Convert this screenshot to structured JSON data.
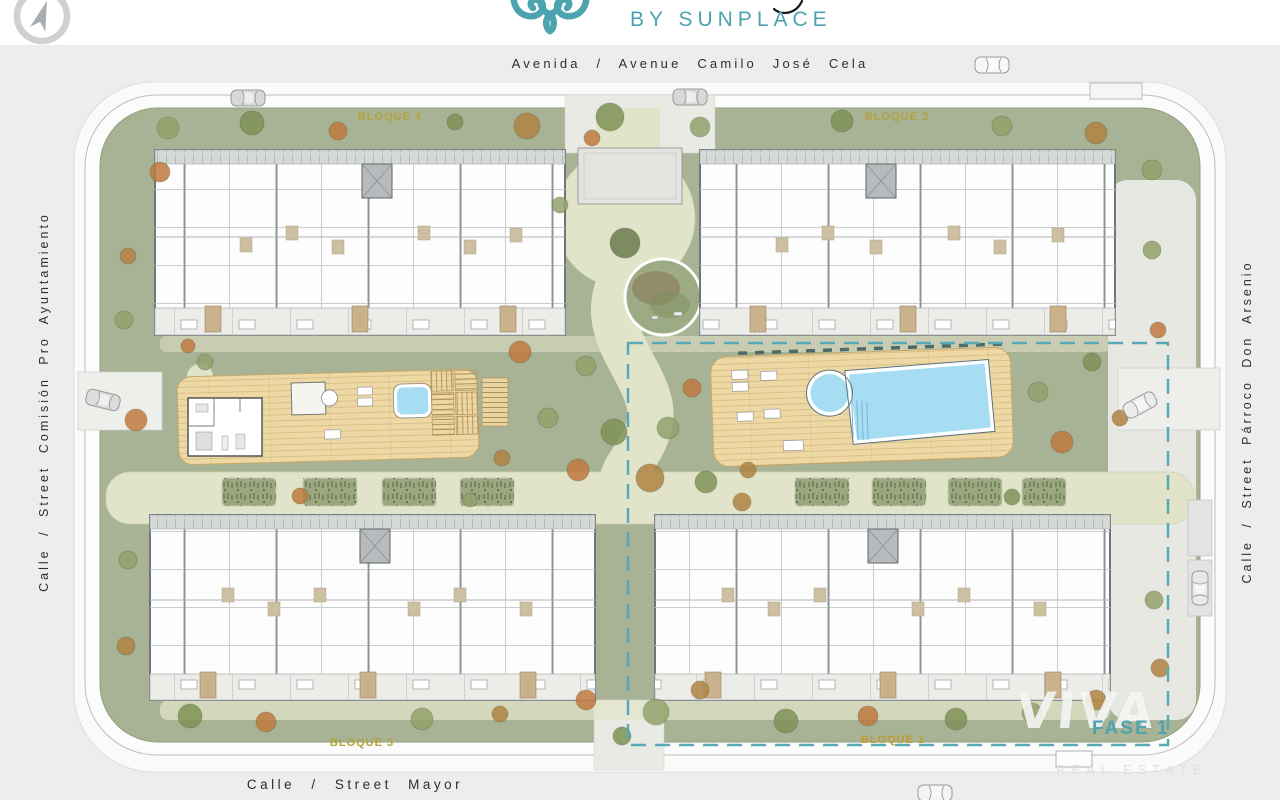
{
  "header": {
    "brand_sub": "BY SUNPLACE"
  },
  "icons": {
    "compass": "compass-rose",
    "brand_emblem": "ornamental-scroll"
  },
  "streets": {
    "top": "Avenida / Avenue Camilo José Cela",
    "left": "Calle / Street Comisión Pro Ayuntamiento",
    "right": "Calle / Street Párroco Don Arsenio",
    "bottom": "Calle / Street Mayor"
  },
  "blocks": {
    "b1": "BLOQUE 1",
    "b2": "BLOQUE 2",
    "b3": "BLOQUE 3",
    "b4": "BLOQUE 4"
  },
  "phase": {
    "label": "FASE 1"
  },
  "watermark": {
    "brand": "VIVA",
    "tagline": "REAL ESTATE"
  },
  "colors": {
    "accent_teal": "#4ba4ae",
    "phase_teal": "#4fa3b1",
    "block_label": "#b2a33c",
    "site_green": "#a8b295",
    "path_cream": "#e2e4ca",
    "deck_tan": "#eed9a5",
    "pool_blue": "#a7ddf2",
    "street_gray": "#ededed"
  }
}
